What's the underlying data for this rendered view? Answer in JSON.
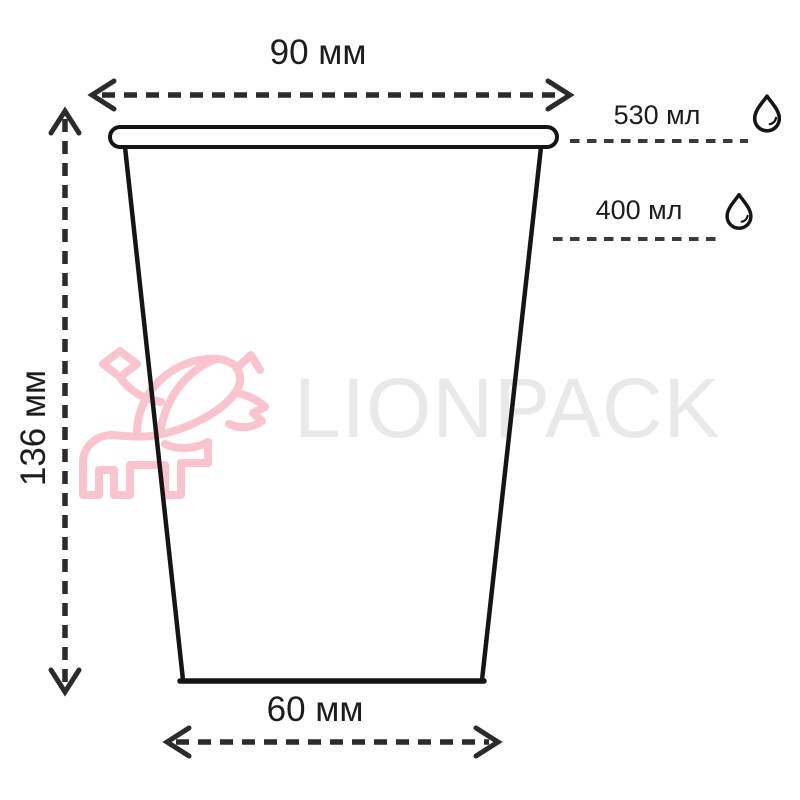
{
  "diagram": {
    "kind": "cup-dimension-drawing",
    "dimensions": {
      "top_width": "90 мм",
      "height": "136 мм",
      "bottom_width": "60 мм"
    },
    "volume_marks": [
      {
        "label": "530 мл",
        "position": "brim-level"
      },
      {
        "label": "400 мл",
        "position": "fill-level"
      }
    ]
  },
  "labels": {
    "top_width": "90 мм",
    "height": "136 мм",
    "bottom_width": "60 мм",
    "volume_full": "530 мл",
    "volume_nominal": "400 мл"
  },
  "watermark": {
    "brand": "LIONPACK"
  },
  "icons": {
    "droplet": "water-drop-icon",
    "logo": "lion-logo-icon"
  },
  "colors": {
    "bg": "#ffffff",
    "ink": "#1d1d1d",
    "line": "#151515",
    "dash": "#2b2b2b",
    "level": "#3a3a3a",
    "pink": "#f9c4ce",
    "wm": "#e9e9e9"
  }
}
